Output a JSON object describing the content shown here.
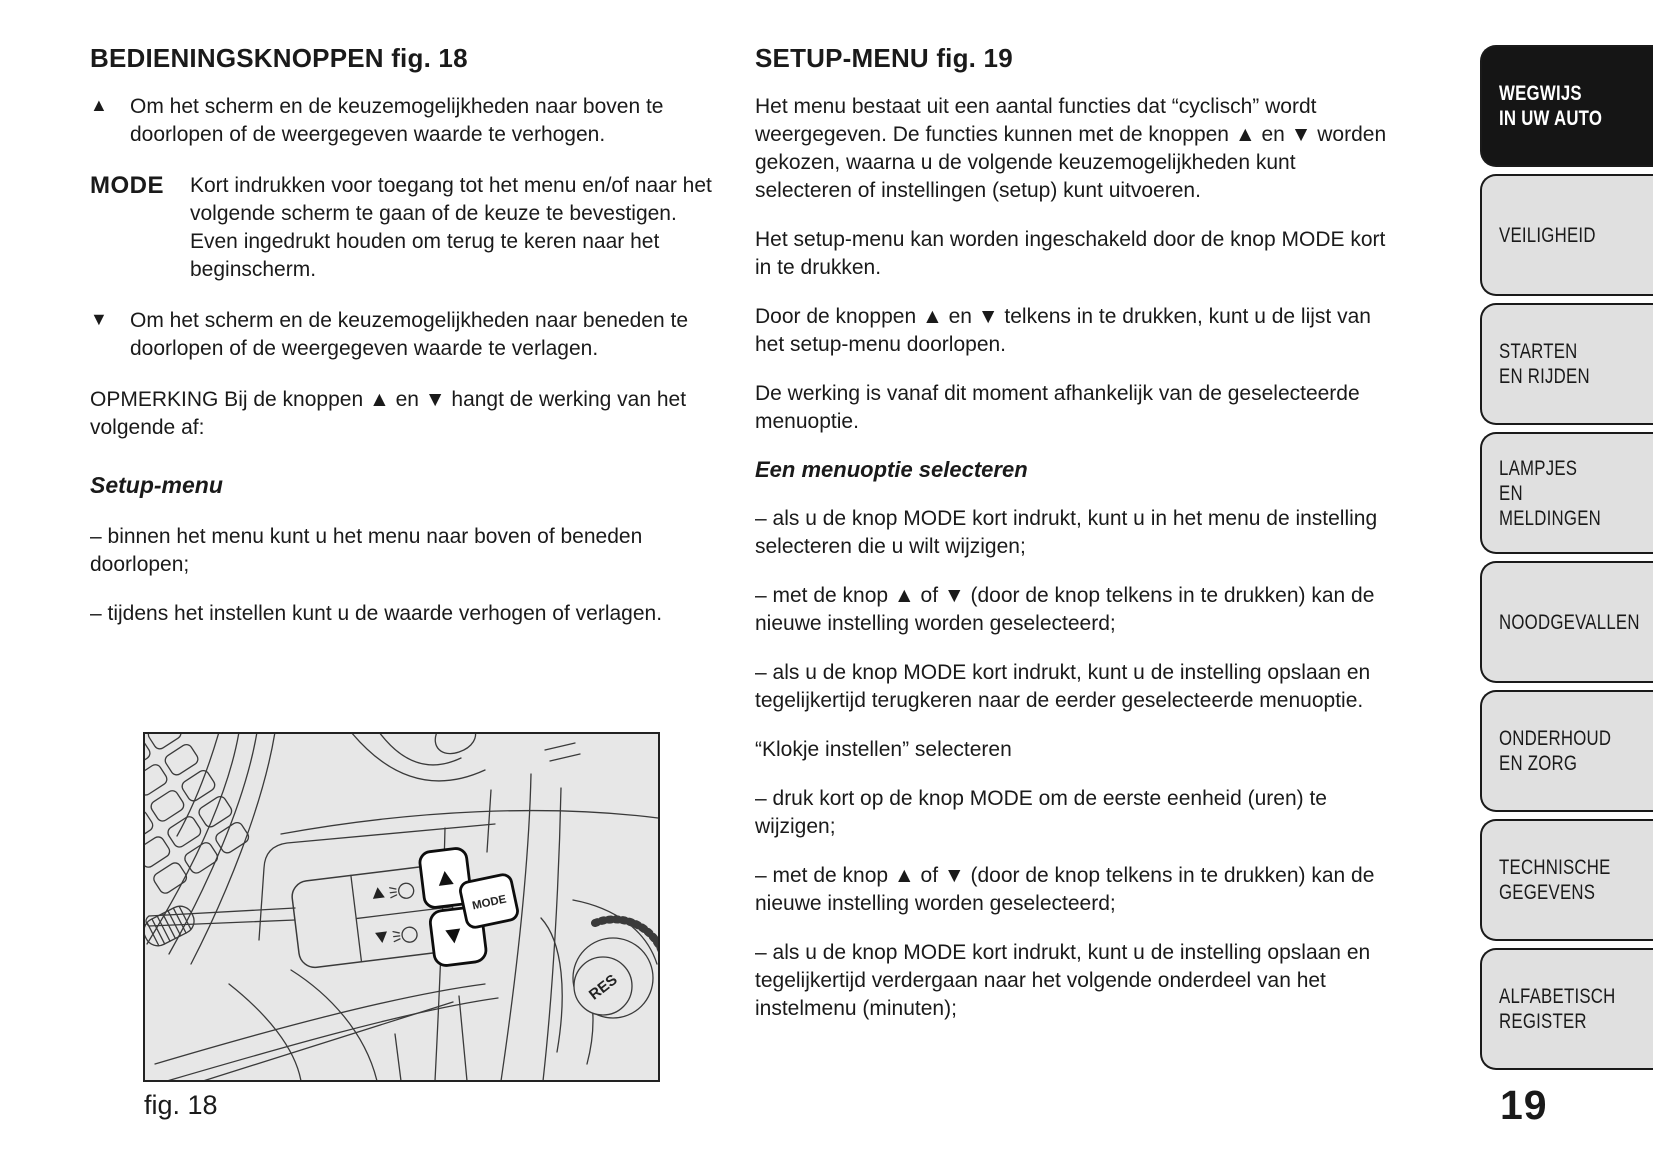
{
  "page": {
    "number": "19"
  },
  "colors": {
    "tab_bg": "#e0e0e0",
    "tab_active_bg": "#151515",
    "tab_active_text": "#ffffff",
    "figure_bg": "#e7e7e7",
    "line_art": "#3a3a3a",
    "text": "#1a1a1a"
  },
  "left_column": {
    "heading": "BEDIENINGSKNOPPEN fig. 18",
    "items": [
      {
        "symbol": "▲",
        "text": "Om het scherm en de keuzemogelijkheden naar boven te doorlopen of de weergegeven waarde te verhogen."
      },
      {
        "symbol": "MODE",
        "text": "Kort indrukken voor toegang tot het menu en/of naar het volgende scherm te gaan of de keuze te bevestigen. Even ingedrukt houden om terug te keren naar het beginscherm."
      },
      {
        "symbol": "▼",
        "text": "Om het scherm en de keuzemogelijkheden naar beneden te doorlopen of de weergegeven waarde te verlagen."
      }
    ],
    "note": "OPMERKING Bij de knoppen ▲ en ▼ hangt de werking van het volgende af:",
    "subheading": "Setup-menu",
    "bullets": [
      "– binnen het menu kunt u het menu naar boven of beneden doorlopen;",
      "– tijdens het instellen kunt u de waarde verhogen of verlagen."
    ]
  },
  "right_column": {
    "heading": "SETUP-MENU fig. 19",
    "para1": "Het menu bestaat uit een aantal functies dat “cyclisch” wordt weergegeven. De functies kunnen met de knoppen ▲ en ▼ worden gekozen, waarna u de volgende keuzemogelijkheden kunt selecteren of instellingen (setup) kunt uitvoeren.",
    "para2": "Het setup-menu kan worden ingeschakeld door de knop MODE kort in te drukken.",
    "para3": "Door de knoppen ▲ en ▼ telkens in te drukken, kunt u de lijst van het setup-menu doorlopen.",
    "para4": "De werking is vanaf dit moment afhankelijk van de geselecteerde menuoptie.",
    "subheading1": "Een menuoptie selecteren",
    "bullet1": "– als u de knop MODE kort indrukt, kunt u in het menu de instelling selecteren die u wilt wijzigen;",
    "bullet2": "– met de knop ▲ of ▼ (door de knop telkens in te drukken) kan de nieuwe instelling worden geselecteerd;",
    "bullet3": "– als u de knop MODE kort indrukt, kunt u de instelling opslaan en tegelijkertijd terugkeren naar de eerder geselecteerde menuoptie.",
    "subheading2": "“Klokje instellen” selecteren",
    "bullet4": "– druk kort op de knop MODE om de eerste eenheid (uren) te wijzigen;",
    "bullet5": "– met de knop ▲ of ▼ (door de knop telkens in te drukken) kan de nieuwe instelling worden geselecteerd;",
    "bullet6": "– als u de knop MODE kort indrukt, kunt u de instelling opslaan en tegelijkertijd verdergaan naar het volgende onderdeel van het instelmenu (minuten);"
  },
  "sidebar": {
    "items": [
      {
        "label": "WEGWIJS\nIN UW AUTO",
        "active": true
      },
      {
        "label": "VEILIGHEID",
        "active": false
      },
      {
        "label": "STARTEN\nEN RIJDEN",
        "active": false
      },
      {
        "label": "LAMPJES\nEN MELDINGEN",
        "active": false
      },
      {
        "label": "NOODGEVALLEN",
        "active": false
      },
      {
        "label": "ONDERHOUD\nEN ZORG",
        "active": false
      },
      {
        "label": "TECHNISCHE\nGEGEVENS",
        "active": false
      },
      {
        "label": "ALFABETISCH\nREGISTER",
        "active": false
      }
    ]
  },
  "figure": {
    "caption": "fig. 18",
    "mode_label": "MODE",
    "res_label": "RES"
  }
}
